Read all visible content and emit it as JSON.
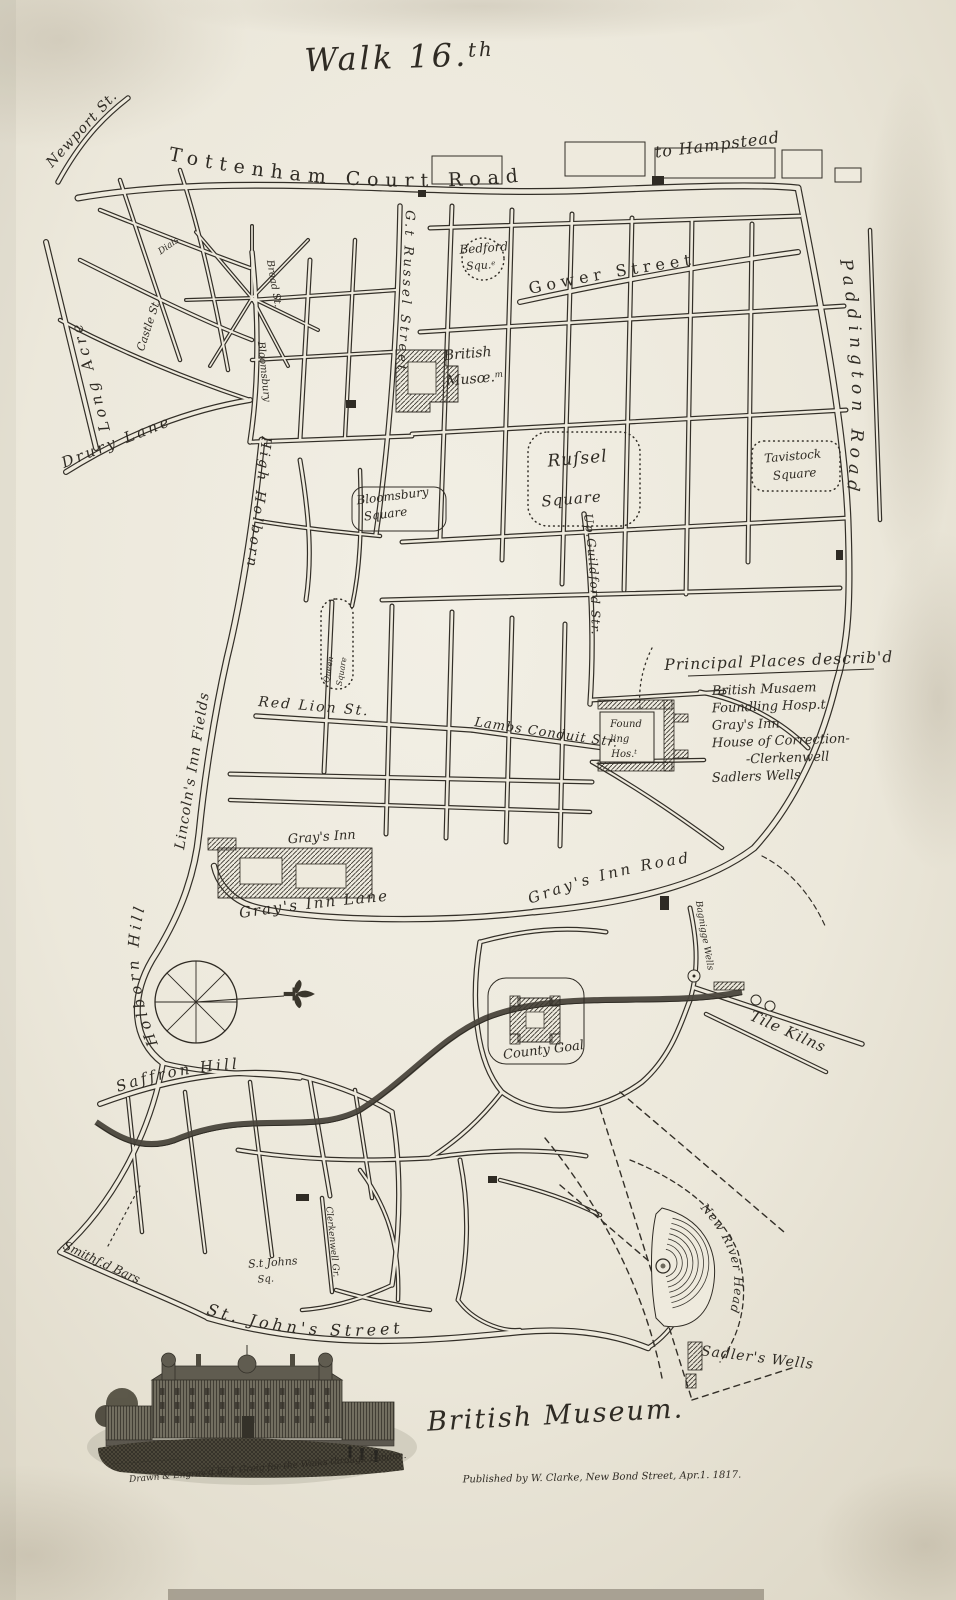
{
  "page": {
    "title": "Walk 16.th"
  },
  "colors": {
    "paper": "#ece8db",
    "paper_hi": "#f2efe5",
    "paper_lo": "#dcd6c5",
    "ink": "#2f2b24",
    "ink_faint": "#7d7669",
    "river": "#4a463c",
    "stain": "#7d7059",
    "plate_strip": "#9d9788"
  },
  "legend": {
    "heading": "Principal Places describ'd",
    "items": [
      {
        "text": "British Musaem",
        "indent": 0
      },
      {
        "text": "Foundling Hosp.t",
        "indent": 0
      },
      {
        "text": "Gray's Inn",
        "indent": 0
      },
      {
        "text": "House of Correction-",
        "indent": 0
      },
      {
        "text": "-Clerkenwell",
        "indent": 34
      },
      {
        "text": "Sadlers Wells",
        "indent": 0
      }
    ]
  },
  "compass": {
    "note": "compass-rose with east-pointing fleur-de-lis"
  },
  "vignette": {
    "subject": "British Museum (Montagu House) engraving"
  },
  "labels": [
    {
      "id": "walk-title",
      "text": "Walk 16.",
      "sup": "th",
      "x": 400,
      "y": 68,
      "rot": -2,
      "size": 32,
      "style": "sc",
      "ls": 3,
      "color": "#8a8376"
    },
    {
      "id": "newport-st",
      "text": "Newport St.",
      "curve": "M52,168 L122,92",
      "size": 14,
      "style": "it",
      "ls": 1
    },
    {
      "id": "tottenham-court-road",
      "text": "Tottenham Court Road",
      "curve": "M168,160 C320,192 470,196 615,168",
      "size": 19,
      "style": "rm",
      "ls": 7
    },
    {
      "id": "to-hampstead",
      "text": "to Hampstead",
      "x": 718,
      "y": 150,
      "rot": -7,
      "size": 16,
      "style": "it",
      "ls": 1
    },
    {
      "id": "gower-street",
      "text": "Gower Street",
      "curve": "M530,294 Q648,268 770,256",
      "size": 16,
      "style": "rm",
      "ls": 5
    },
    {
      "id": "paddington-road",
      "text": "Paddington Road",
      "curve": "M840,260 C858,360 856,470 834,568",
      "size": 17,
      "style": "it",
      "ls": 6
    },
    {
      "id": "gt-russel-street",
      "text": "G.t Russel Street",
      "curve": "M406,210 C402,320 396,426 378,532",
      "size": 13,
      "style": "it",
      "ls": 3
    },
    {
      "id": "bedford-square-1",
      "text": "Bedford",
      "x": 484,
      "y": 252,
      "rot": -4,
      "size": 12,
      "style": "it"
    },
    {
      "id": "bedford-square-2",
      "text": "Squ.",
      "sup": "e",
      "x": 481,
      "y": 269,
      "rot": -4,
      "size": 11,
      "style": "it"
    },
    {
      "id": "british-museum-1",
      "text": "British",
      "x": 468,
      "y": 358,
      "rot": -5,
      "size": 14,
      "style": "it"
    },
    {
      "id": "british-museum-2",
      "text": "Musœ.",
      "sup": "m",
      "x": 475,
      "y": 383,
      "rot": -5,
      "size": 14,
      "style": "it"
    },
    {
      "id": "russel-square-1",
      "text": "Ruſsel",
      "x": 578,
      "y": 464,
      "rot": -5,
      "size": 17,
      "style": "it",
      "ls": 1
    },
    {
      "id": "russel-square-2",
      "text": "Square",
      "x": 572,
      "y": 504,
      "rot": -5,
      "size": 15,
      "style": "it",
      "ls": 1
    },
    {
      "id": "tavistock-square-1",
      "text": "Tavistock",
      "x": 793,
      "y": 460,
      "rot": -5,
      "size": 12,
      "style": "it"
    },
    {
      "id": "tavistock-square-2",
      "text": "Square",
      "x": 795,
      "y": 478,
      "rot": -5,
      "size": 12,
      "style": "it"
    },
    {
      "id": "bloomsbury-square-1",
      "text": "Bloomsbury",
      "x": 393,
      "y": 500,
      "rot": -7,
      "size": 12,
      "style": "it"
    },
    {
      "id": "bloomsbury-square-2",
      "text": "Square",
      "x": 386,
      "y": 518,
      "rot": -7,
      "size": 12,
      "style": "it"
    },
    {
      "id": "up-guildford-str",
      "text": "Up.Guildford Str.",
      "curve": "M584,514 C592,578 594,644 589,704",
      "size": 12,
      "style": "it",
      "ls": 1
    },
    {
      "id": "queen-square-1",
      "text": "Queen",
      "x": 331,
      "y": 670,
      "rot": -80,
      "size": 8,
      "style": "it"
    },
    {
      "id": "queen-square-2",
      "text": "Square",
      "x": 344,
      "y": 672,
      "rot": -80,
      "size": 8,
      "style": "it"
    },
    {
      "id": "lincolns-inn-fields",
      "text": "Lincoln's Inn Fields",
      "curve": "M184,850 L224,598",
      "size": 14,
      "style": "it",
      "ls": 1
    },
    {
      "id": "high-holborn",
      "text": "High Holborn",
      "curve": "M262,436 C252,532 244,602 224,700",
      "size": 14,
      "style": "it",
      "ls": 3
    },
    {
      "id": "holborn-hill",
      "text": "Holborn Hill",
      "curve": "M158,1044 C122,962 140,892 178,838",
      "size": 15,
      "style": "it",
      "ls": 4
    },
    {
      "id": "red-lion-st",
      "text": "Red Lion St.",
      "curve": "M258,706 L468,724",
      "size": 14,
      "style": "it",
      "ls": 2
    },
    {
      "id": "lambs-conduit-str",
      "text": "Lambs Conduit Str.",
      "curve": "M474,726 L652,752",
      "size": 13,
      "style": "it",
      "ls": 1
    },
    {
      "id": "grays-inn",
      "text": "Gray's Inn",
      "x": 322,
      "y": 841,
      "rot": -4,
      "size": 13,
      "style": "it"
    },
    {
      "id": "grays-inn-lane",
      "text": "Gray's Inn Lane",
      "curve": "M240,918 Q335,904 436,897",
      "size": 15,
      "style": "it",
      "ls": 2
    },
    {
      "id": "grays-inn-road",
      "text": "Gray's Inn Road",
      "curve": "M530,904 C622,870 700,856 778,858",
      "size": 15,
      "style": "it",
      "ls": 3
    },
    {
      "id": "bagnigge-wells",
      "text": "Bagnigge Wells",
      "x": 702,
      "y": 936,
      "rot": 80,
      "size": 9,
      "style": "it"
    },
    {
      "id": "tile-kilns",
      "text": "Tile Kilns",
      "x": 786,
      "y": 1036,
      "rot": 24,
      "size": 15,
      "style": "it",
      "ls": 1
    },
    {
      "id": "county-goal",
      "text": "County Goal",
      "x": 544,
      "y": 1054,
      "rot": -7,
      "size": 13,
      "style": "it"
    },
    {
      "id": "saffron-hill",
      "text": "Saffron Hill",
      "curve": "M118,1092 Q205,1062 298,1070",
      "size": 15,
      "style": "it",
      "ls": 3
    },
    {
      "id": "smithfield-bars",
      "text": "Smithf.d Bars",
      "x": 100,
      "y": 1266,
      "rot": 25,
      "size": 12,
      "style": "it"
    },
    {
      "id": "st-johns-sq-1",
      "text": "S.t Johns",
      "x": 273,
      "y": 1266,
      "rot": -4,
      "size": 11,
      "style": "it"
    },
    {
      "id": "st-johns-sq-2",
      "text": "Sq.",
      "x": 266,
      "y": 1282,
      "rot": -4,
      "size": 10,
      "style": "it"
    },
    {
      "id": "clerkenwell-gr",
      "text": "Clerkenwell Gr.",
      "x": 330,
      "y": 1242,
      "rot": 84,
      "size": 9,
      "style": "it"
    },
    {
      "id": "st-johns-street",
      "text": "St. John's Street",
      "curve": "M206,1314 Q330,1352 456,1324",
      "size": 16,
      "style": "it",
      "ls": 4
    },
    {
      "id": "new-river-head",
      "text": "New River Head",
      "curve": "M700,1208 C742,1252 744,1300 714,1344",
      "size": 12,
      "style": "it",
      "ls": 1
    },
    {
      "id": "sadlers-wells",
      "text": "Sadler's Wells",
      "x": 757,
      "y": 1362,
      "rot": 7,
      "size": 14,
      "style": "it",
      "ls": 1
    },
    {
      "id": "long-acre",
      "text": "Long Acre",
      "curve": "M110,430 L58,236",
      "size": 15,
      "style": "it",
      "ls": 4
    },
    {
      "id": "drury-lane",
      "text": "Drury Lane",
      "curve": "M64,468 L250,394",
      "size": 15,
      "style": "it",
      "ls": 3
    },
    {
      "id": "castle-st",
      "text": "Castle St.",
      "x": 152,
      "y": 326,
      "rot": -72,
      "size": 11,
      "style": "it"
    },
    {
      "id": "dials",
      "text": "Dials",
      "x": 170,
      "y": 248,
      "rot": -35,
      "size": 9,
      "style": "it"
    },
    {
      "id": "broad-st",
      "text": "Broad St.",
      "x": 271,
      "y": 284,
      "rot": 80,
      "size": 10,
      "style": "it"
    },
    {
      "id": "bloomsbury-street",
      "text": "Bloomsbury",
      "x": 261,
      "y": 372,
      "rot": 84,
      "size": 10,
      "style": "it"
    },
    {
      "id": "foundling-1",
      "text": "Found",
      "x": 626,
      "y": 727,
      "rot": 0,
      "size": 10,
      "style": "it"
    },
    {
      "id": "foundling-2",
      "text": "-ling",
      "x": 618,
      "y": 742,
      "rot": 0,
      "size": 10,
      "style": "it"
    },
    {
      "id": "foundling-3",
      "text": "Hos.",
      "sup": "t",
      "x": 624,
      "y": 757,
      "rot": 0,
      "size": 10,
      "style": "it"
    },
    {
      "id": "british-museum-script",
      "text": "British Museum.",
      "x": 556,
      "y": 1424,
      "rot": -3,
      "size": 27,
      "style": "sc",
      "ls": 2,
      "color": "#7d7669"
    },
    {
      "id": "credit-engraver",
      "text": "Drawn & Engrav'd by J. Greig for the Walks through London.",
      "x": 268,
      "y": 1470,
      "rot": -5,
      "size": 9,
      "style": "sc",
      "color": "#6d675c"
    },
    {
      "id": "credit-publisher",
      "text": "Published by W. Clarke, New Bond Street, Apr.1. 1817.",
      "x": 602,
      "y": 1480,
      "rot": -1,
      "size": 10,
      "style": "sc",
      "color": "#6d675c"
    }
  ]
}
